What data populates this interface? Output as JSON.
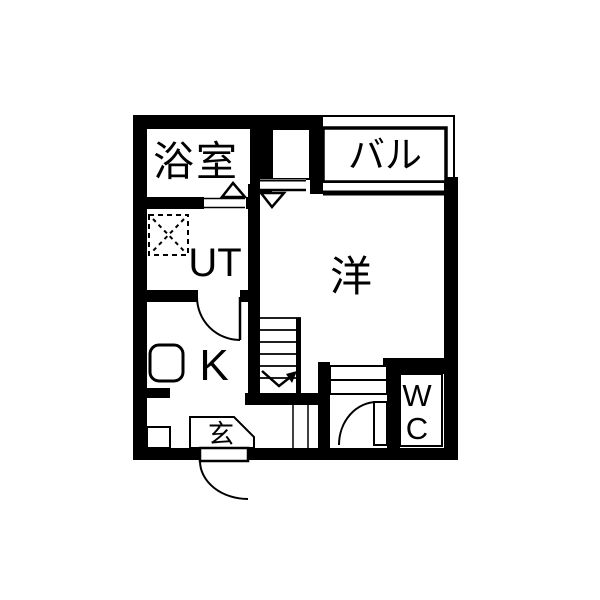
{
  "colors": {
    "wall": "#000000",
    "background": "#ffffff",
    "line": "#000000"
  },
  "rooms": {
    "bathroom": {
      "label": "浴室"
    },
    "balcony": {
      "label": "バル"
    },
    "western_room": {
      "label": "洋"
    },
    "utility": {
      "label": "UT"
    },
    "kitchen": {
      "label": "K"
    },
    "entrance": {
      "label": "玄"
    },
    "toilet": {
      "line1": "W",
      "line2": "C"
    }
  }
}
